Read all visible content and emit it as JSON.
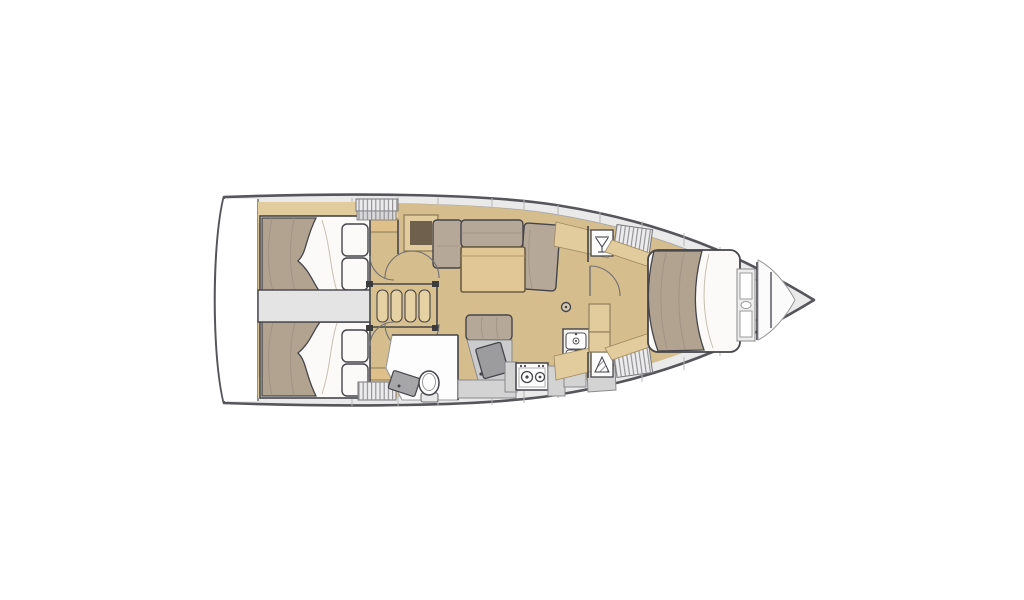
{
  "plan": {
    "type": "sailing-yacht-interior-floor-plan",
    "orientation": "bow-right",
    "palette": {
      "outline": "#4b4b4d",
      "deck": "#eaeaeb",
      "interior": "#f6f6f5",
      "sole": "#d6bd8e",
      "wood": "#e2cb9c",
      "wood_step": "#e6d1a4",
      "duvet": "#b2a391",
      "cushion": "#b6a899",
      "white_linen": "#fbfaf8",
      "corridor": "#e4e4e5",
      "counter": "#d3d3d4",
      "desk": "#9c9c9e",
      "brown_inset": "#6e604d",
      "hatch_line": "#8e8e90",
      "bow_locker": "#fbfbfb"
    },
    "rooms": [
      {
        "name": "aft-cabin-port",
        "features": [
          "double-bed",
          "two-pillows",
          "wood-shelf"
        ]
      },
      {
        "name": "aft-cabin-starboard",
        "features": [
          "double-bed",
          "two-pillows",
          "wood-shelf"
        ]
      },
      {
        "name": "engine-corridor",
        "features": [
          "access-panel"
        ]
      },
      {
        "name": "companionway",
        "features": [
          "steps-4"
        ]
      },
      {
        "name": "saloon",
        "features": [
          "l-shaped-sofa",
          "dining-table",
          "sideboard",
          "bench-seat",
          "nav-desk",
          "mast-post"
        ]
      },
      {
        "name": "aft-head",
        "features": [
          "toilet",
          "washbasin-counter",
          "door-arcs"
        ]
      },
      {
        "name": "galley",
        "features": [
          "two-burner-stove",
          "double-sink",
          "counters",
          "locker"
        ]
      },
      {
        "name": "forward-passage",
        "features": [
          "washbasin-icon",
          "shower-icon",
          "hanging-lockers",
          "cabinet-column",
          "door-arc"
        ]
      },
      {
        "name": "forward-cabin",
        "features": [
          "island-double-bed",
          "shelf-unit",
          "bulkheads",
          "bow-locker"
        ]
      }
    ],
    "icons": [
      "washbasin-icon",
      "shower-icon",
      "toilet-icon",
      "stove-icon",
      "double-sink-icon",
      "door-swing-arc",
      "hanging-locker-hatch",
      "mast-post-icon"
    ]
  }
}
